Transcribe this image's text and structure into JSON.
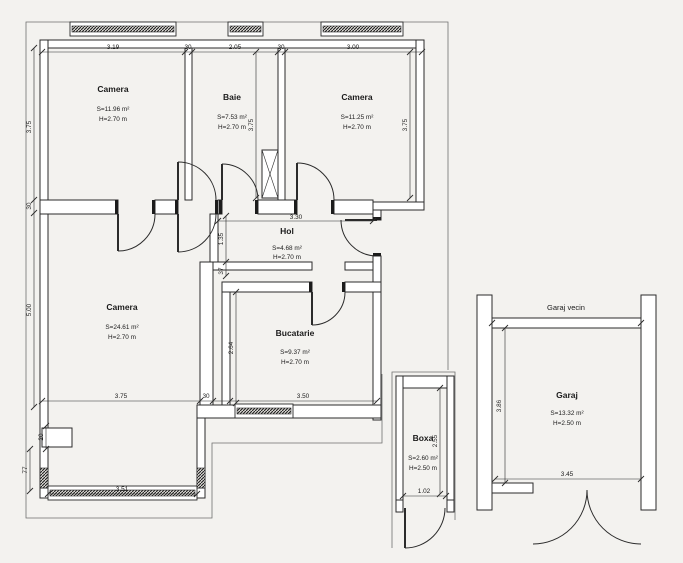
{
  "colors": {
    "line": "#2b2b2b",
    "background": "#f3f2ef",
    "contour": "#6f6f6f",
    "text": "#1b1b1b"
  },
  "rooms": [
    {
      "name": "Camera",
      "area": "S=11.96 m²",
      "height": "H=2.70 m"
    },
    {
      "name": "Baie",
      "area": "S=7.53 m²",
      "height": "H=2.70 m"
    },
    {
      "name": "Camera",
      "area": "S=11.25 m²",
      "height": "H=2.70 m"
    },
    {
      "name": "Hol",
      "area": "S=4.68 m²",
      "height": "H=2.70 m"
    },
    {
      "name": "Camera",
      "area": "S=24.61 m²",
      "height": "H=2.70 m"
    },
    {
      "name": "Bucatarie",
      "area": "S=9.37 m²",
      "height": "H=2.70 m"
    },
    {
      "name": "Boxa",
      "area": "S=2.60 m²",
      "height": "H=2.50 m"
    },
    {
      "name": "Garaj",
      "area": "S=13.32 m²",
      "height": "H=2.50 m"
    }
  ],
  "labels": {
    "garaj_vecin": "Garaj vecin"
  },
  "dims": {
    "top": [
      "3.19",
      "30",
      "2.05",
      "30",
      "3.00"
    ],
    "left": [
      "3.75",
      "30",
      "5.00",
      "20",
      "77"
    ],
    "baie_right": "3.75",
    "camera2_right": "3.75",
    "hol_top": "3.30",
    "hol_left": [
      "1.35",
      "37"
    ],
    "bucatarie_left": "2.64",
    "bottom": [
      "3.75",
      "30",
      "3.50"
    ],
    "bay_window": "3.51",
    "boxa_bottom": "1.02",
    "boxa_right": "2.55",
    "garaj_left": "3.86",
    "garaj_bottom": "3.45"
  }
}
